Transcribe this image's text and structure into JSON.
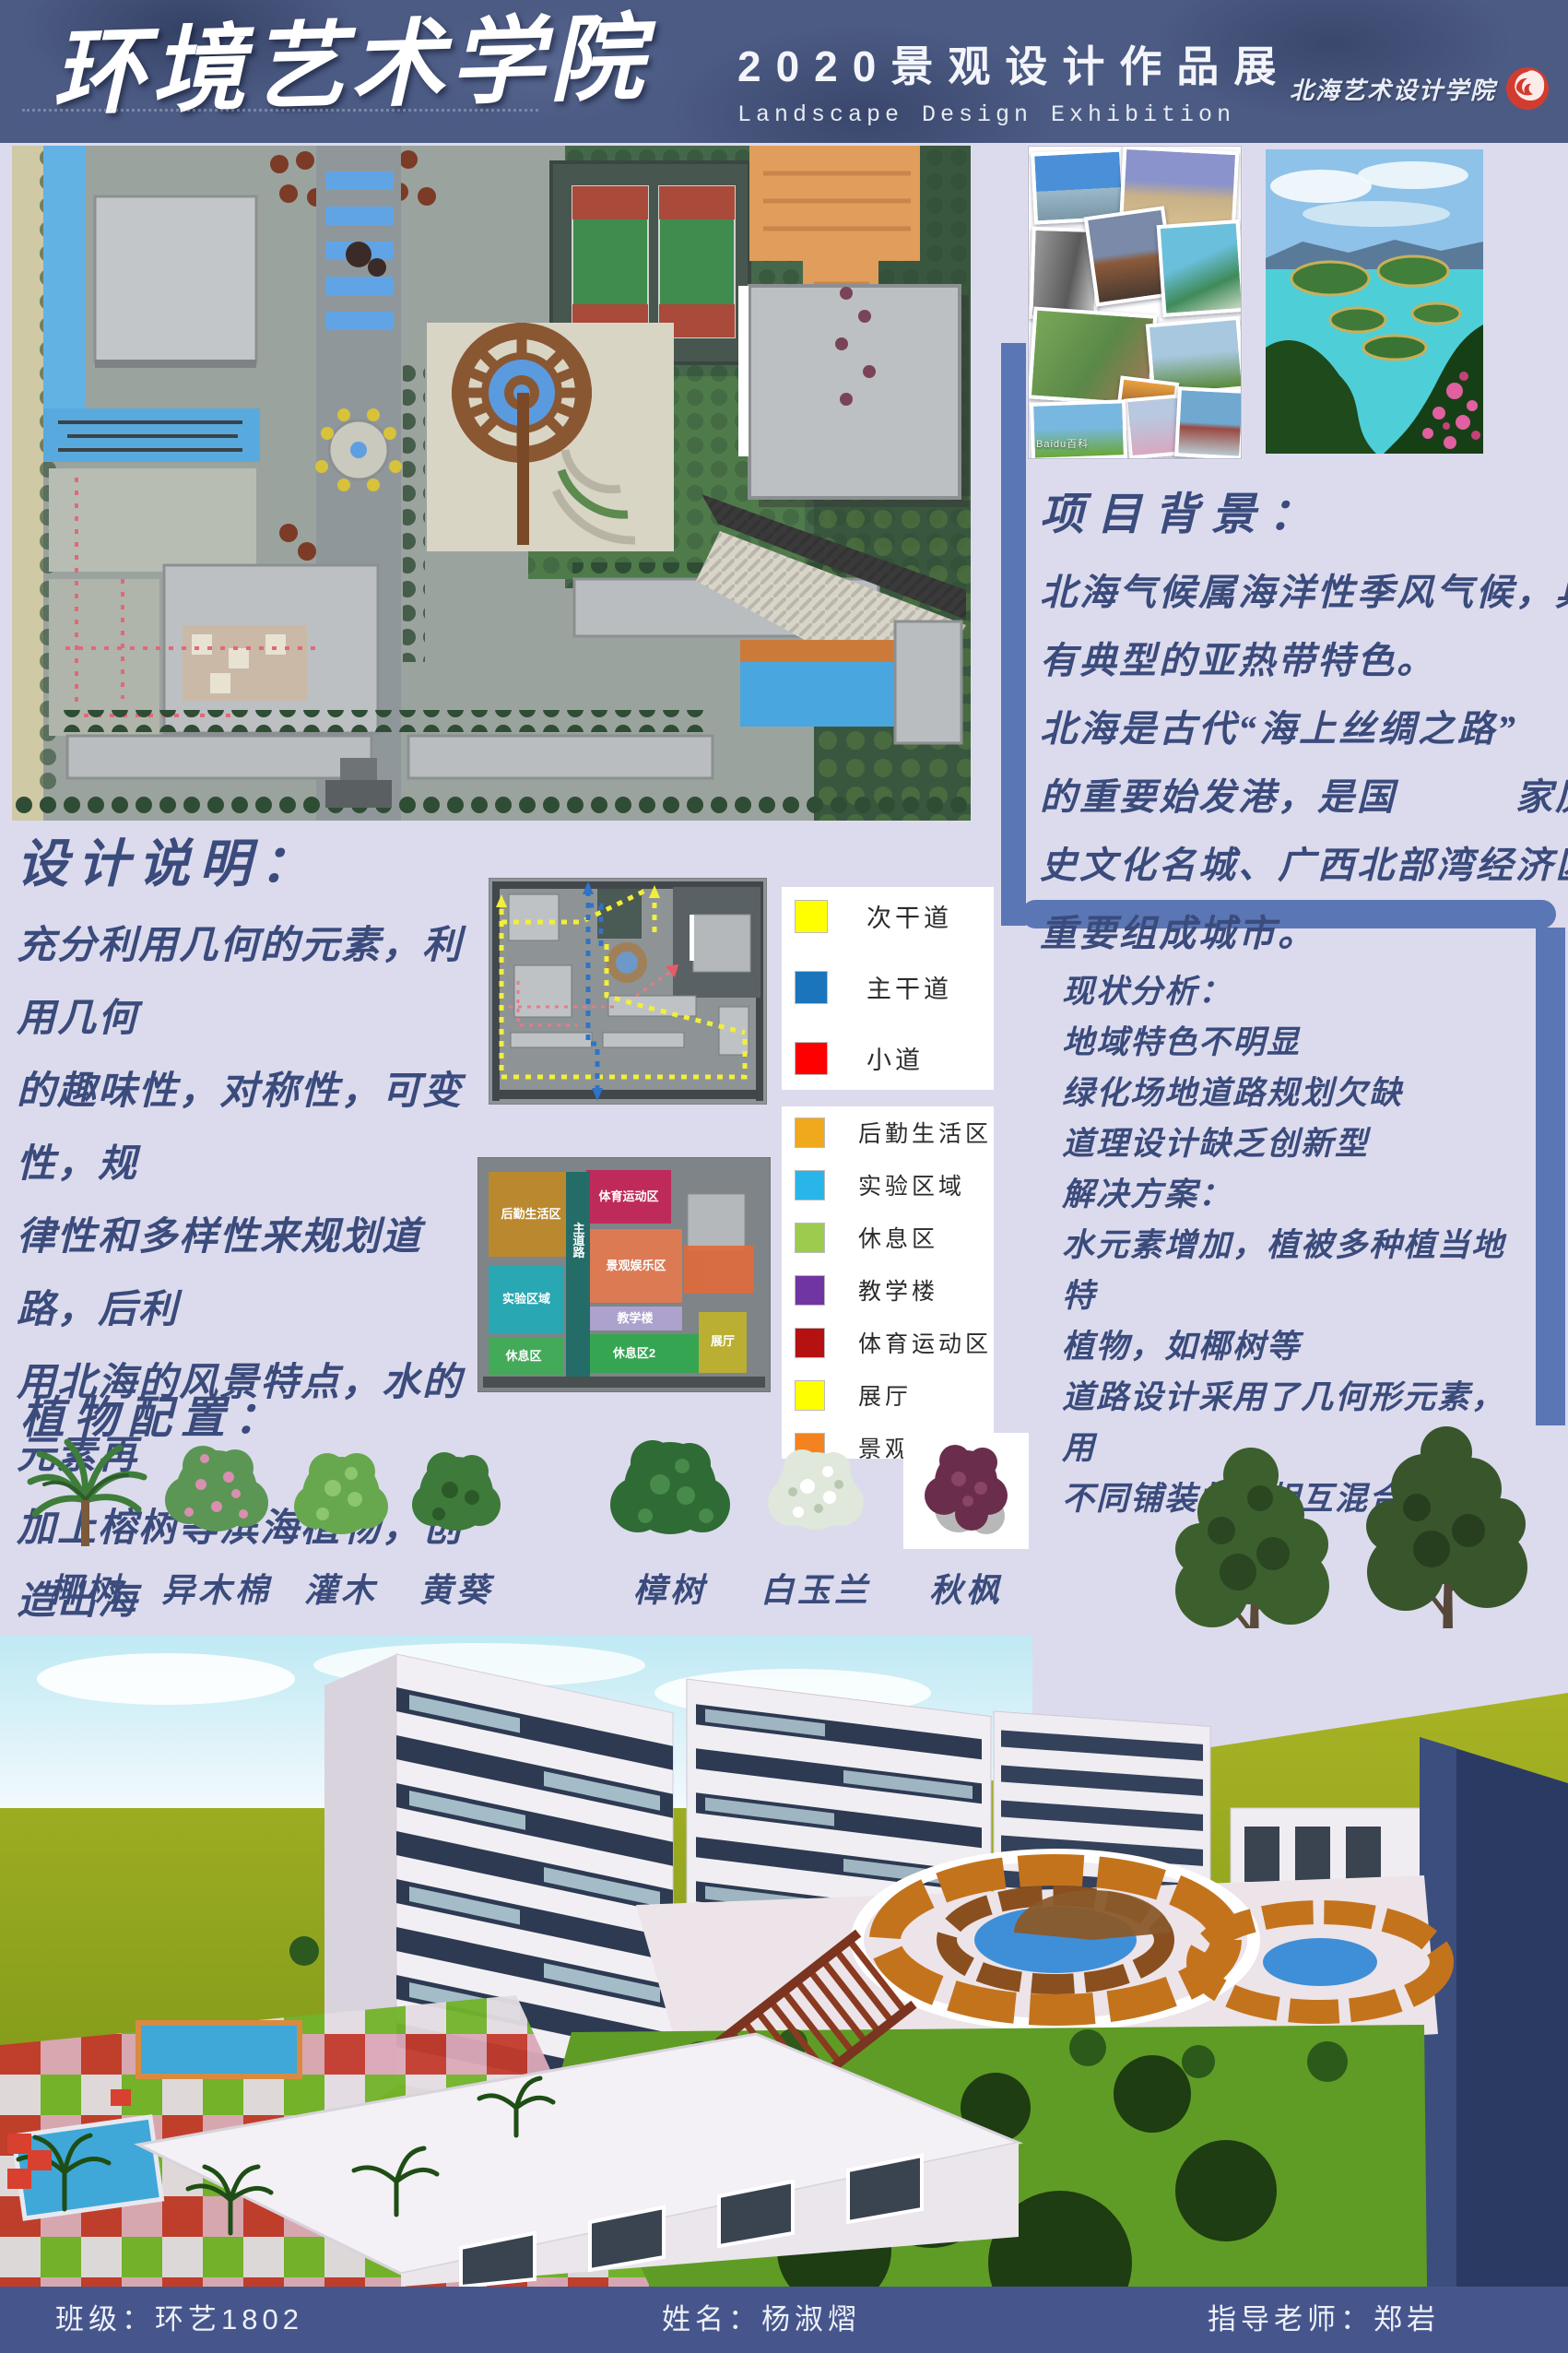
{
  "header": {
    "school_title": "环境艺术学院",
    "exhibition_title": "2020景观设计作品展",
    "exhibition_subtitle": "Landscape Design Exhibition",
    "logo_text": "北海艺术设计学院",
    "logo_color": "#d23c2f"
  },
  "project_background": {
    "title": "项目背景：",
    "lines": [
      "北海气候属海洋性季风气候，具",
      "有典型的亚热带特色。",
      "北海是古代“海上丝绸之路”",
      "的重要始发港，是国　　　家历",
      "史文化名城、广西北部湾经济区",
      "重要组成城市。"
    ]
  },
  "design_notes": {
    "title": "设计说明：",
    "lines": [
      "充分利用几何的元素，利用几何",
      "的趣味性，对称性，可变性，规",
      "律性和多样性来规划道路，后利",
      "用北海的风景特点，水的元素再",
      "加上榕树等滨海植物，创造出海",
      "岛的特色，让学院能与周围环境",
      "，与该城市相契合。"
    ]
  },
  "status_analysis": {
    "lines": [
      "现状分析：",
      "地域特色不明显",
      "绿化场地道路规划欠缺",
      "道理设计缺乏创新型",
      "解决方案：",
      "水元素增加，植被多种植当地特",
      "植物，如椰树等",
      "道路设计采用了几何形元素，用",
      "不同铺装材料相互混合"
    ]
  },
  "plants": {
    "title": "植物配置：",
    "items": [
      "椰树",
      "异木棉",
      "灌木",
      "黄葵",
      "樟树",
      "白玉兰",
      "秋枫"
    ]
  },
  "road_legend": [
    {
      "label": "次干道",
      "color": "#ffff00"
    },
    {
      "label": "主干道",
      "color": "#1b75bc"
    },
    {
      "label": "小道",
      "color": "#ff0000"
    }
  ],
  "zone_legend": [
    {
      "label": "后勤生活区",
      "color": "#f0a81c"
    },
    {
      "label": "实验区域",
      "color": "#29b5e8"
    },
    {
      "label": "休息区",
      "color": "#9ccb4e"
    },
    {
      "label": "教学楼",
      "color": "#7135a3"
    },
    {
      "label": "体育运动区",
      "color": "#b51111"
    },
    {
      "label": "展厅",
      "color": "#feff00"
    },
    {
      "label": "景观娱乐区",
      "color": "#f58220"
    }
  ],
  "zoning_map": {
    "labels": [
      "后勤生活区",
      "体育运动区",
      "实验区域",
      "景观娱乐区",
      "教学楼",
      "休息区",
      "休息区2",
      "展厅"
    ],
    "road_label": "主道路"
  },
  "collage": {
    "watermark": "Baidu百科"
  },
  "footer": {
    "class_field": "班级：环艺1802",
    "name_field": "姓名：杨淑熠",
    "advisor_field": "指导老师：郑岩"
  }
}
